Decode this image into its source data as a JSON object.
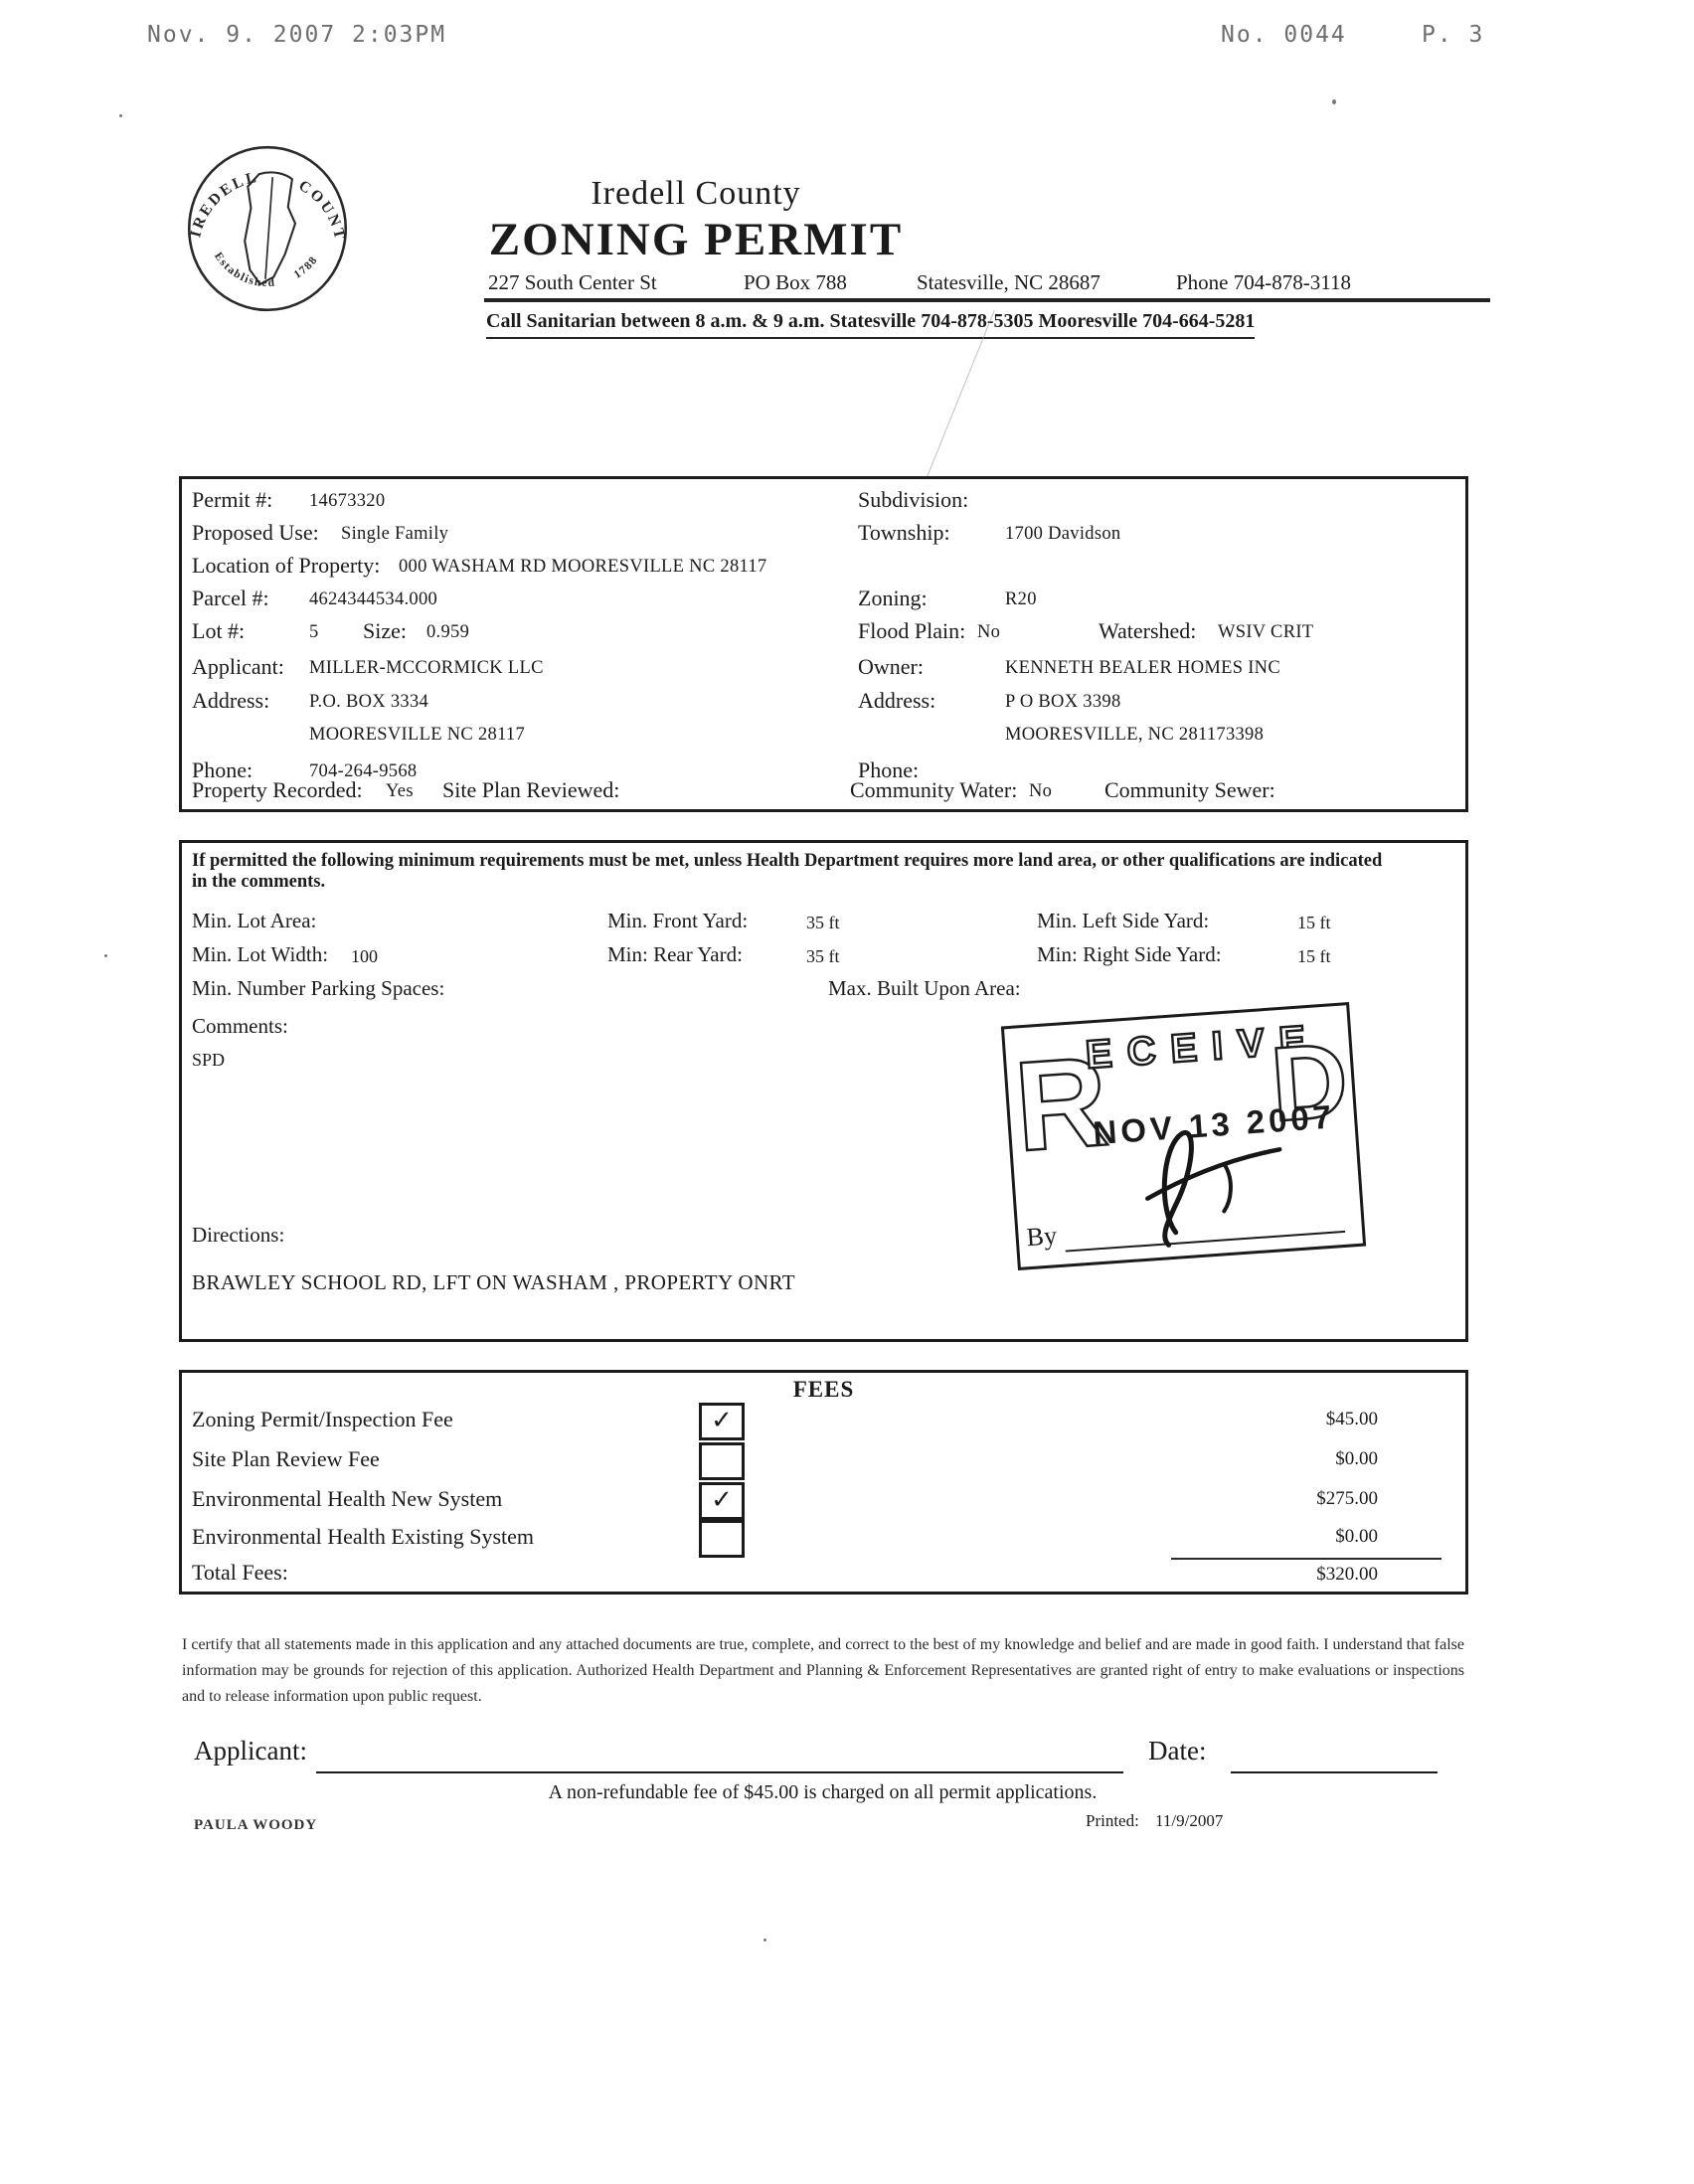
{
  "colors": {
    "ink": "#1b1b1b",
    "fax_gray": "#555555"
  },
  "fax_header": {
    "datetime": "Nov. 9. 2007  2:03PM",
    "fax_no": "No. 0044",
    "page_no": "P. 3"
  },
  "seal": {
    "arc_top_left": "IREDELL",
    "arc_top_right": "COUNTY",
    "arc_bottom_left": "Established",
    "arc_bottom_right": "1788"
  },
  "header": {
    "county": "Iredell County",
    "title": "ZONING PERMIT",
    "street": "227 South Center St",
    "po_box": "PO Box 788",
    "city": "Statesville, NC 28687",
    "phone": "Phone 704-878-3118",
    "sanitarian": "Call Sanitarian between 8 a.m. & 9 a.m. Statesville 704-878-5305 Mooresville 704-664-5281"
  },
  "permit": {
    "permit_label": "Permit #:",
    "permit_value": "14673320",
    "subdivision_label": "Subdivision:",
    "subdivision_value": "",
    "proposed_use_label": "Proposed Use:",
    "proposed_use_value": "Single Family",
    "township_label": "Township:",
    "township_value": "1700 Davidson",
    "location_label": "Location of Property:",
    "location_value": "000 WASHAM RD MOORESVILLE NC 28117",
    "parcel_label": "Parcel #:",
    "parcel_value": "4624344534.000",
    "zoning_label": "Zoning:",
    "zoning_value": "R20",
    "lot_label": "Lot #:",
    "lot_value": "5",
    "size_label": "Size:",
    "size_value": "0.959",
    "flood_label": "Flood Plain:",
    "flood_value": "No",
    "watershed_label": "Watershed:",
    "watershed_value": "WSIV CRIT",
    "applicant_label": "Applicant:",
    "applicant_value": "MILLER-MCCORMICK LLC",
    "owner_label": "Owner:",
    "owner_value": "KENNETH BEALER HOMES INC",
    "applicant_address_label": "Address:",
    "applicant_address1": "P.O. BOX 3334",
    "applicant_address2": "MOORESVILLE NC 28117",
    "owner_address_label": "Address:",
    "owner_address1": "P O BOX 3398",
    "owner_address2": "MOORESVILLE, NC 281173398",
    "applicant_phone_label": "Phone:",
    "applicant_phone_value": "704-264-9568",
    "owner_phone_label": "Phone:",
    "owner_phone_value": "",
    "recorded_label": "Property Recorded:",
    "recorded_value": "Yes",
    "site_plan_label": "Site Plan Reviewed:",
    "site_plan_value": "",
    "community_water_label": "Community Water:",
    "community_water_value": "No",
    "community_sewer_label": "Community Sewer:",
    "community_sewer_value": ""
  },
  "requirements": {
    "intro": "If permitted the following minimum requirements must be met, unless Health Department requires more land area, or other qualifications are indicated in the comments.",
    "min_lot_area_label": "Min. Lot Area:",
    "min_lot_area_value": "",
    "min_front_yard_label": "Min. Front Yard:",
    "min_front_yard_value": "35 ft",
    "min_left_side_label": "Min. Left Side Yard:",
    "min_left_side_value": "15 ft",
    "min_lot_width_label": "Min. Lot Width:",
    "min_lot_width_value": "100",
    "min_rear_yard_label": "Min: Rear Yard:",
    "min_rear_yard_value": "35 ft",
    "min_right_side_label": "Min: Right Side Yard:",
    "min_right_side_value": "15 ft",
    "min_parking_label": "Min. Number Parking Spaces:",
    "min_parking_value": "",
    "max_built_label": "Max. Built Upon Area:",
    "max_built_value": "",
    "comments_label": "Comments:",
    "comments_value": "SPD",
    "directions_label": "Directions:",
    "directions_value": "BRAWLEY SCHOOL RD, LFT ON WASHAM , PROPERTY ONRT"
  },
  "stamp": {
    "letter_first": "R",
    "letters_mid": "ECEIVE",
    "letter_last": "D",
    "date": "NOV 13 2007",
    "by_label": "By"
  },
  "fees": {
    "title": "FEES",
    "rows": [
      {
        "label": "Zoning Permit/Inspection Fee",
        "checked": true,
        "mark": "✓",
        "amount": "$45.00"
      },
      {
        "label": "Site Plan Review Fee",
        "checked": false,
        "mark": "",
        "amount": "$0.00"
      },
      {
        "label": "Environmental Health New System",
        "checked": true,
        "mark": "✓",
        "amount": "$275.00"
      },
      {
        "label": "Environmental Health Existing System",
        "checked": false,
        "mark": "",
        "amount": "$0.00"
      }
    ],
    "total_label": "Total Fees:",
    "total_amount": "$320.00"
  },
  "certification": "I certify that all statements made in this application and any attached documents are true, complete, and correct to the best of my knowledge and belief and are made in good faith. I understand that false information may be grounds for rejection of this application. Authorized Health Department and Planning & Enforcement Representatives are granted right of entry to make evaluations or inspections and to release information upon public request.",
  "footer": {
    "applicant_label": "Applicant:",
    "date_label": "Date:",
    "fee_note": "A non-refundable fee of $45.00 is charged on all permit applications.",
    "prepared_by": "PAULA WOODY",
    "printed_label": "Printed:",
    "printed_value": "11/9/2007"
  }
}
